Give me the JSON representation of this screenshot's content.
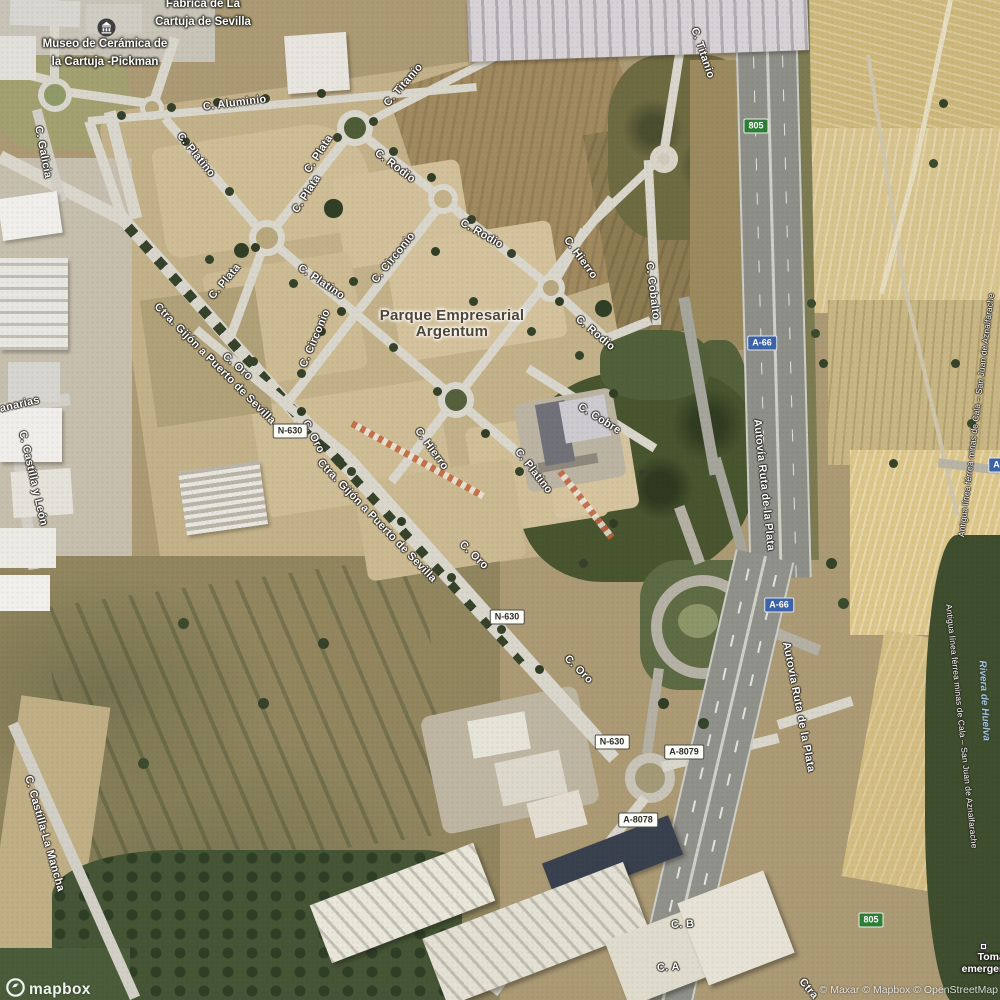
{
  "map": {
    "type": "satellite"
  },
  "brand": {
    "logo": "mapbox",
    "attribution": "© Maxar © Mapbox © OpenStreetMap"
  },
  "places": {
    "factory": [
      "Fábrica de La",
      "Cartuja de Sevilla"
    ],
    "museum": [
      "Museo de Cerámica de",
      "la Cartuja -Pickman"
    ],
    "business_park": [
      "Parque Empresarial",
      "Argentum"
    ],
    "emergency": [
      "Toma de",
      "emergencia"
    ]
  },
  "streets": {
    "aluminio": "C. Aluminio",
    "titanio": "C. Titanio",
    "platino": "C. Platino",
    "plata": "C. Plata",
    "rodio": "C. Rodio",
    "circonio": "C. Circonio",
    "cobalto": "C. Cobalto",
    "hierro": "C. Hierro",
    "cobre": "C. Cobre",
    "oro": "C. Oro",
    "ctra_gijon": "Ctra. Gijón a Puerto de Sevilla",
    "ctra_short": "Ctra",
    "galicia": "C. Galicia",
    "canarias": "anarias",
    "castilla_leon": "C. Castilla y León",
    "castilla_mancha": "C. Castilla-La Mancha",
    "autovia": "Autovía Ruta de la Plata",
    "calle_b": "C. B",
    "calle_a": "C. A"
  },
  "features": {
    "railway": "Antigua línea férrea minas de Cala – San Juan de Aznalfarache",
    "river": "Rivera de Huelva"
  },
  "shields": {
    "a66": "A-66",
    "n630": "N-630",
    "a8079": "A-8079",
    "a8078": "A-8078",
    "km805": "805",
    "a_partial": "A-"
  },
  "colors": {
    "shield_green": "#2e7d36",
    "shield_blue": "#3c63a8",
    "shield_white": "#fdfdf8",
    "road": "#d9d6cc",
    "field_tan": "#cbb891",
    "woods": "#49552f",
    "water_label": "#a8c4de"
  }
}
